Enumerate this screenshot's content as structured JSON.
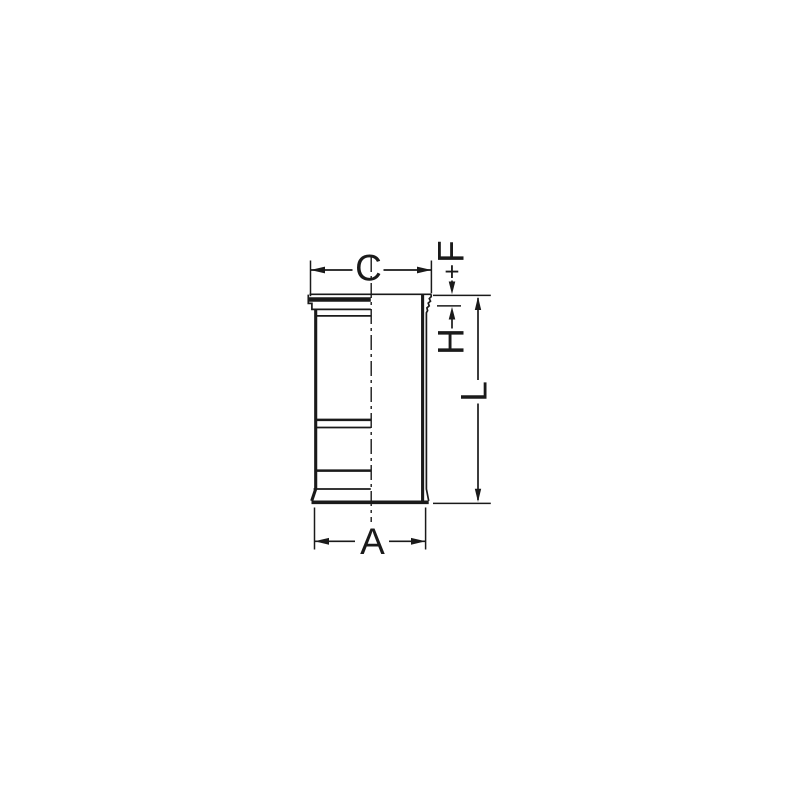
{
  "figure": {
    "description": "Technical line drawing of a cylinder liner (side view with collar at top), dimensioned",
    "colors": {
      "background": "#ffffff",
      "line": "#1a1a1a"
    }
  },
  "labels": {
    "c": "C",
    "f": "F",
    "f_plus": "+",
    "h": "H",
    "l": "L",
    "a": "A"
  }
}
